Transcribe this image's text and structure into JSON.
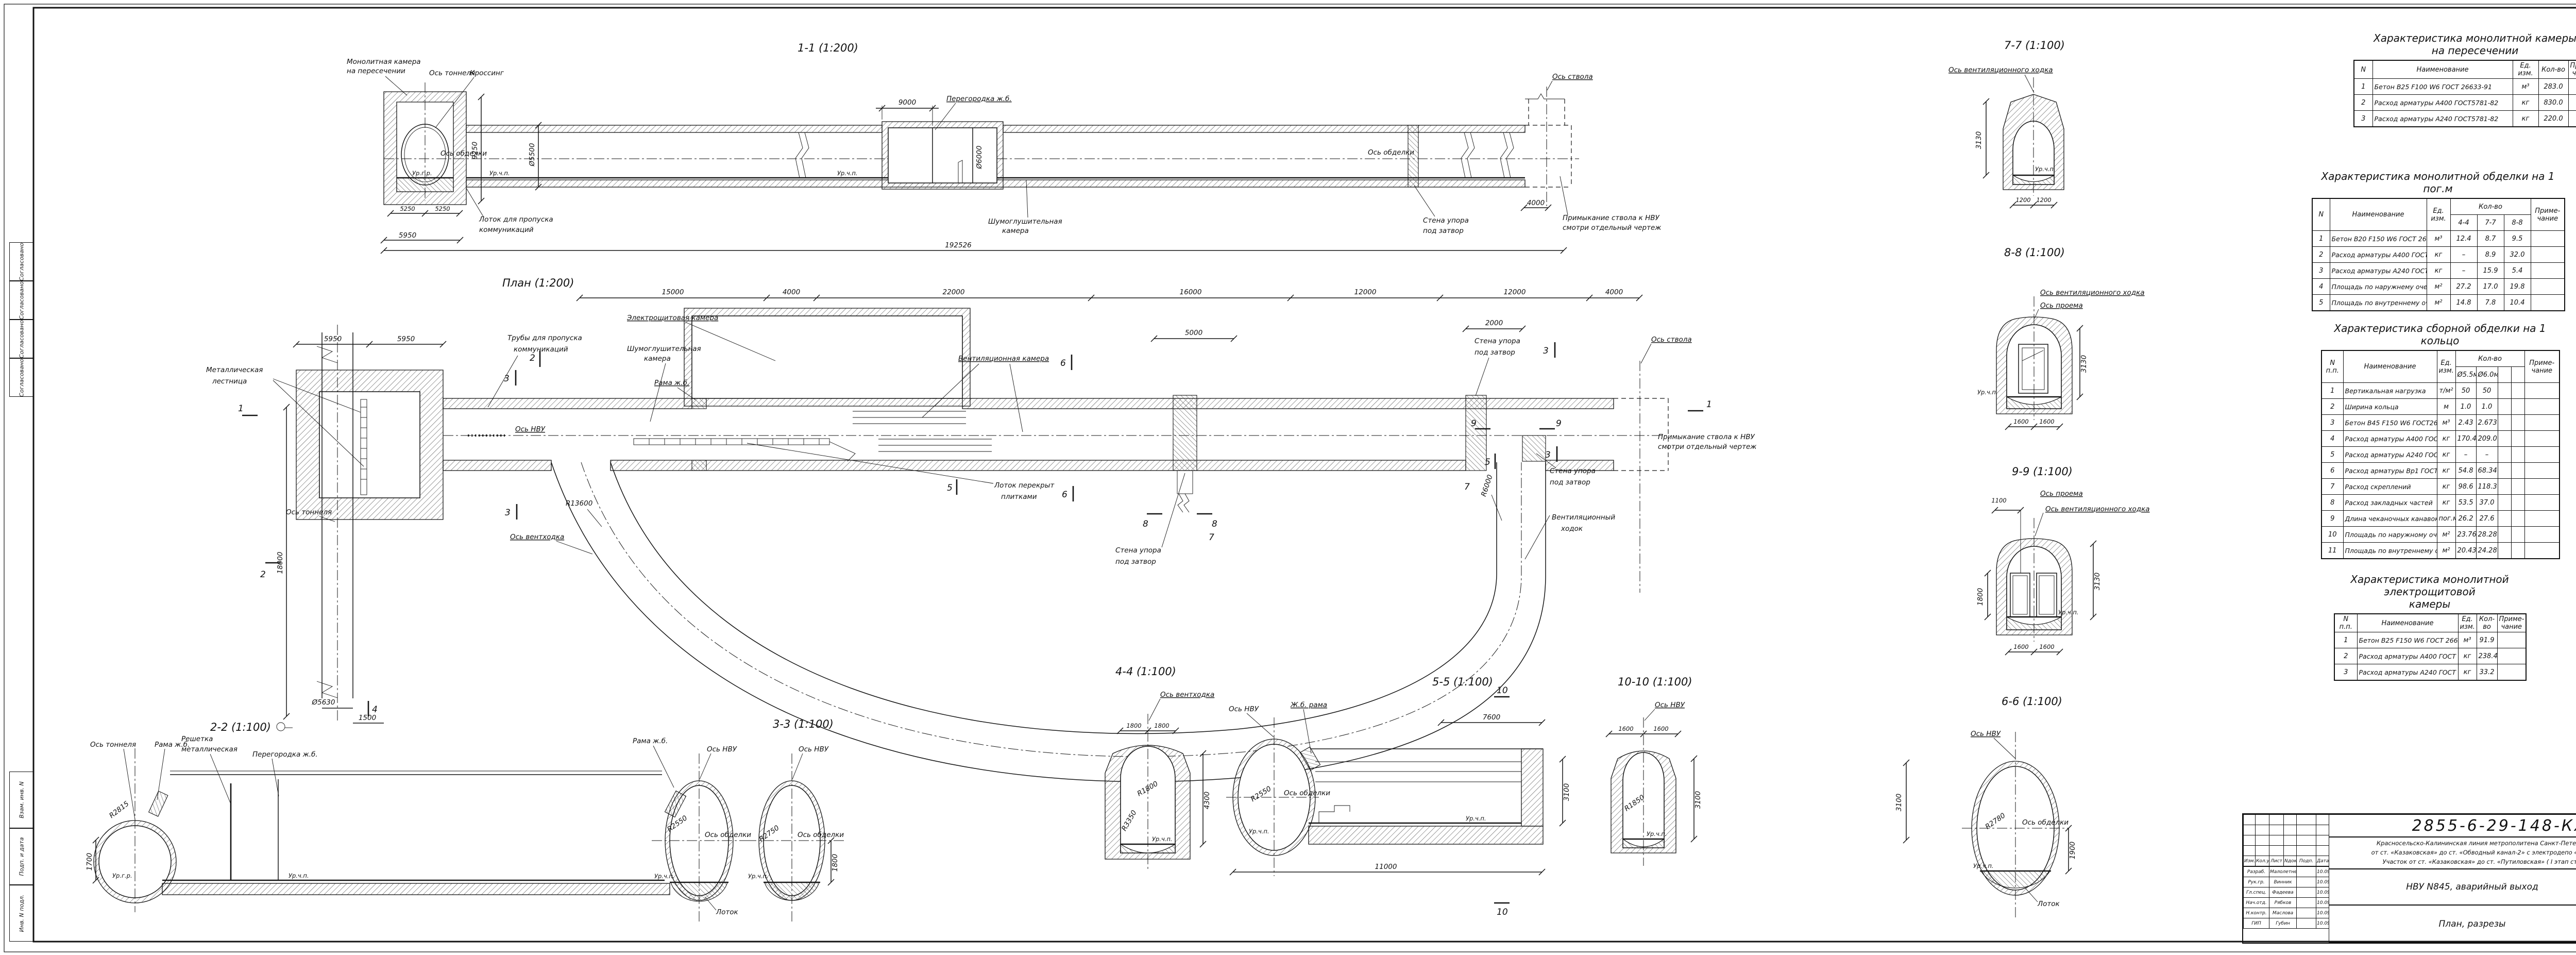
{
  "common": {
    "axis_tunnel": "Ось тоннеля",
    "axis_lining": "Ось обделки",
    "axis_nvu": "Ось НВУ",
    "axis_shaft": "Ось ствола",
    "axis_vent": "Ось вентиляционного ходка",
    "axis_ventkhodka": "Ось вентходка",
    "axis_opening": "Ось проема",
    "ur_gr": "Ур.г.р.",
    "ur_chp": "Ур.ч.п.",
    "lotok": "Лоток",
    "rama": "Рама ж.б.",
    "zhb_rama": "Ж.б. рама",
    "wall1": "Стена упора",
    "wall2": "под затвор",
    "partition": "Перегородка ж.б.",
    "noise1": "Шумоглушительная",
    "noise2": "камера",
    "adj1": "Примыкание ствола к НВУ",
    "adj2": "смотри отдельный чертеж"
  },
  "sections": {
    "s11": {
      "title": "1-1 (1:200)",
      "chamber1": "Монолитная камера",
      "chamber2": "на пересечении",
      "crossing": "Кроссинг",
      "lotok1": "Лоток для пропуска",
      "lotok2": "коммуникаций"
    },
    "plan": {
      "title": "План (1:200)",
      "ladder1": "Металлическая",
      "ladder2": "лестница",
      "pipes1": "Трубы для пропуска",
      "pipes2": "коммуникаций",
      "elec": "Электрощитовая камера",
      "vent_chamber": "Вентиляционная камера",
      "lotok_plit1": "Лоток перекрыт",
      "lotok_plit2": "плитками",
      "vk1": "Вентиляционный",
      "vk2": "ходок"
    },
    "s22": {
      "title": "2-2 (1:100)",
      "grate1": "Решетка",
      "grate2": "металлическая"
    },
    "s33": {
      "title": "3-3 (1:100)"
    },
    "s44": {
      "title": "4-4 (1:100)"
    },
    "s55": {
      "title": "5-5 (1:100)"
    },
    "s66": {
      "title": "6-6 (1:100)"
    },
    "s77": {
      "title": "7-7 (1:100)"
    },
    "s88": {
      "title": "8-8 (1:100)"
    },
    "s99": {
      "title": "9-9 (1:100)"
    },
    "s1010": {
      "title": "10-10 (1:100)"
    }
  },
  "dims": {
    "d1100": "1100",
    "d1200": "1200",
    "d1500": "1500",
    "d1600": "1600",
    "d1700": "1700",
    "d1800": "1800",
    "d1900": "1900",
    "d2000": "2000",
    "d3100": "3100",
    "d3130": "3130",
    "d4000": "4000",
    "d4300": "4300",
    "d5000": "5000",
    "d5250": "5250",
    "d5950": "5950",
    "d7600": "7600",
    "d9000": "9000",
    "d9250": "9250",
    "d11000": "11000",
    "d12000": "12000",
    "d15000": "15000",
    "d16000": "16000",
    "d18000": "18000",
    "d22000": "22000",
    "d192526": "192526",
    "dia5500": "Ø5500",
    "dia5630": "Ø5630",
    "dia6000": "Ø6000",
    "r1800": "R1800",
    "r1850": "R1850",
    "r2550": "R2550",
    "r2750": "R2750",
    "r2780": "R2780",
    "r2815": "R2815",
    "r3350": "R3350",
    "r6000": "R6000",
    "r13600": "R13600"
  },
  "marks": {
    "m1": "1",
    "m2": "2",
    "m3": "3",
    "m4": "4",
    "m5": "5",
    "m6": "6",
    "m7": "7",
    "m8": "8",
    "m9": "9",
    "m10": "10"
  },
  "tables": {
    "t1": {
      "title1": "Характеристика монолитной камеры",
      "title2": "на пересечении",
      "h_n": "N",
      "h_name": "Наименование",
      "h_unit": "Ед. изм.",
      "h_qty": "Кол-во",
      "h_note": "Приме- чание",
      "rows": [
        [
          "1",
          "Бетон В25 F100 W6 ГОСТ 26633-91",
          "м³",
          "283.0",
          ""
        ],
        [
          "2",
          "Расход арматуры А400 ГОСТ5781-82",
          "кг",
          "830.0",
          ""
        ],
        [
          "3",
          "Расход арматуры А240 ГОСТ5781-82",
          "кг",
          "220.0",
          ""
        ]
      ]
    },
    "t2": {
      "title": "Характеристика монолитной обделки на 1 пог.м",
      "h_n": "N",
      "h_name": "Наименование",
      "h_unit": "Ед. изм.",
      "h_qty": "Кол-во",
      "h_note": "Приме- чание",
      "sub": [
        "4-4",
        "7-7",
        "8-8"
      ],
      "rows": [
        [
          "1",
          "Бетон В20 F150 W6 ГОСТ 26633-91",
          "м³",
          "12.4",
          "8.7",
          "9.5",
          ""
        ],
        [
          "2",
          "Расход арматуры А400 ГОСТ 5781-82",
          "кг",
          "–",
          "8.9",
          "32.0",
          ""
        ],
        [
          "3",
          "Расход арматуры А240 ГОСТ 5781-82",
          "кг",
          "–",
          "15.9",
          "5.4",
          ""
        ],
        [
          "4",
          "Площадь по наружнему очертанию",
          "м²",
          "27.2",
          "17.0",
          "19.8",
          ""
        ],
        [
          "5",
          "Площадь по внутреннему очертанию",
          "м²",
          "14.8",
          "7.8",
          "10.4",
          ""
        ]
      ]
    },
    "t3": {
      "title": "Характеристика сборной обделки на 1 кольцо",
      "h_n": "N п.п.",
      "h_name": "Наименование",
      "h_unit": "Ед. изм.",
      "h_qty": "Кол-во",
      "h_note": "Приме- чание",
      "sub": [
        "Ø5.5м",
        "Ø6.0м",
        "",
        ""
      ],
      "rows": [
        [
          "1",
          "Вертикальная нагрузка",
          "т/м²",
          "50",
          "50",
          "",
          "",
          ""
        ],
        [
          "2",
          "Ширина кольца",
          "м",
          "1.0",
          "1.0",
          "",
          "",
          ""
        ],
        [
          "3",
          "Бетон В45 F150 W6 ГОСТ26633-91",
          "м³",
          "2.43",
          "2.673",
          "",
          "",
          ""
        ],
        [
          "4",
          "Расход арматуры А400 ГОСТ 5781-82",
          "кг",
          "170.4",
          "209.0",
          "",
          "",
          ""
        ],
        [
          "5",
          "Расход арматуры А240 ГОСТ 5781-82",
          "кг",
          "–",
          "–",
          "",
          "",
          ""
        ],
        [
          "6",
          "Расход арматуры Вр1 ГОСТ 6727-80",
          "кг",
          "54.8",
          "68.34",
          "",
          "",
          ""
        ],
        [
          "7",
          "Расход скреплений",
          "кг",
          "98.6",
          "118.3",
          "",
          "",
          ""
        ],
        [
          "8",
          "Расход закладных частей",
          "кг",
          "53.5",
          "37.0",
          "",
          "",
          ""
        ],
        [
          "9",
          "Длина чеканочных канавок",
          "пог.м",
          "26.2",
          "27.6",
          "",
          "",
          ""
        ],
        [
          "10",
          "Площадь по наружному очертанию",
          "м²",
          "23.76",
          "28.28",
          "",
          "",
          ""
        ],
        [
          "11",
          "Площадь по внутреннему очертанию",
          "м²",
          "20.43",
          "24.28",
          "",
          "",
          ""
        ]
      ]
    },
    "t4": {
      "title1": "Характеристика монолитной электрощитовой",
      "title2": "камеры",
      "h_n": "N п.п.",
      "h_name": "Наименование",
      "h_unit": "Ед. изм.",
      "h_qty": "Кол- во",
      "h_note": "Приме- чание",
      "rows": [
        [
          "1",
          "Бетон В25 F150 W6 ГОСТ 26633-91",
          "м³",
          "91.9",
          ""
        ],
        [
          "2",
          "Расход арматуры А400 ГОСТ 5781-82",
          "кг",
          "238.4",
          ""
        ],
        [
          "3",
          "Расход арматуры А240 ГОСТ 5781-82",
          "кг",
          "33.2",
          ""
        ]
      ]
    }
  },
  "titleblock": {
    "code": "2855-6-29-148-КЖ",
    "desc1": "Красносельско-Калининская линия метрополитена Санкт-Петербурга (линия 6)",
    "desc2": "от ст. «Казаковская» до ст. «Обводный канал-2» с электродепо «Красносельское».",
    "desc3": "Участок от ст. «Казаковская» до ст. «Путиловская» ( I этап строительства ).",
    "object": "НВУ N845, аварийный выход",
    "doc_title": "План, разрезы",
    "stage_label": "Стадия",
    "sheet_label": "Лист",
    "sheets_label": "Листов",
    "stage": "П",
    "sheet": "1",
    "sheets": "1",
    "org1": "ОАО",
    "org2": "ЛЕНМЕТРОГИПРОТРАНС",
    "cols": [
      "Изм.",
      "Кол.уч.",
      "Лист",
      "Nдок.",
      "Подп.",
      "Дата"
    ],
    "sign_rows": [
      [
        "Разраб.",
        "Малолетнева",
        "",
        "10.09.13"
      ],
      [
        "Рук.гр.",
        "Винник",
        "",
        "10.09.13"
      ],
      [
        "Гл.спец.",
        "Фадеева",
        "",
        "10.09.13"
      ],
      [
        "Нач.отд.",
        "Рябков",
        "",
        "10.09.13"
      ],
      [
        "Н.контр.",
        "Маслова",
        "",
        "10.09.13"
      ],
      [
        "ГИП",
        "Губин",
        "",
        "10.09.13"
      ]
    ]
  },
  "frame": {
    "stamps": [
      "Согласовано",
      "Согласовано",
      "Согласовано",
      "Согласовано",
      "Взам. инв. N",
      "Подп. и дата",
      "Инв. N подл."
    ]
  }
}
